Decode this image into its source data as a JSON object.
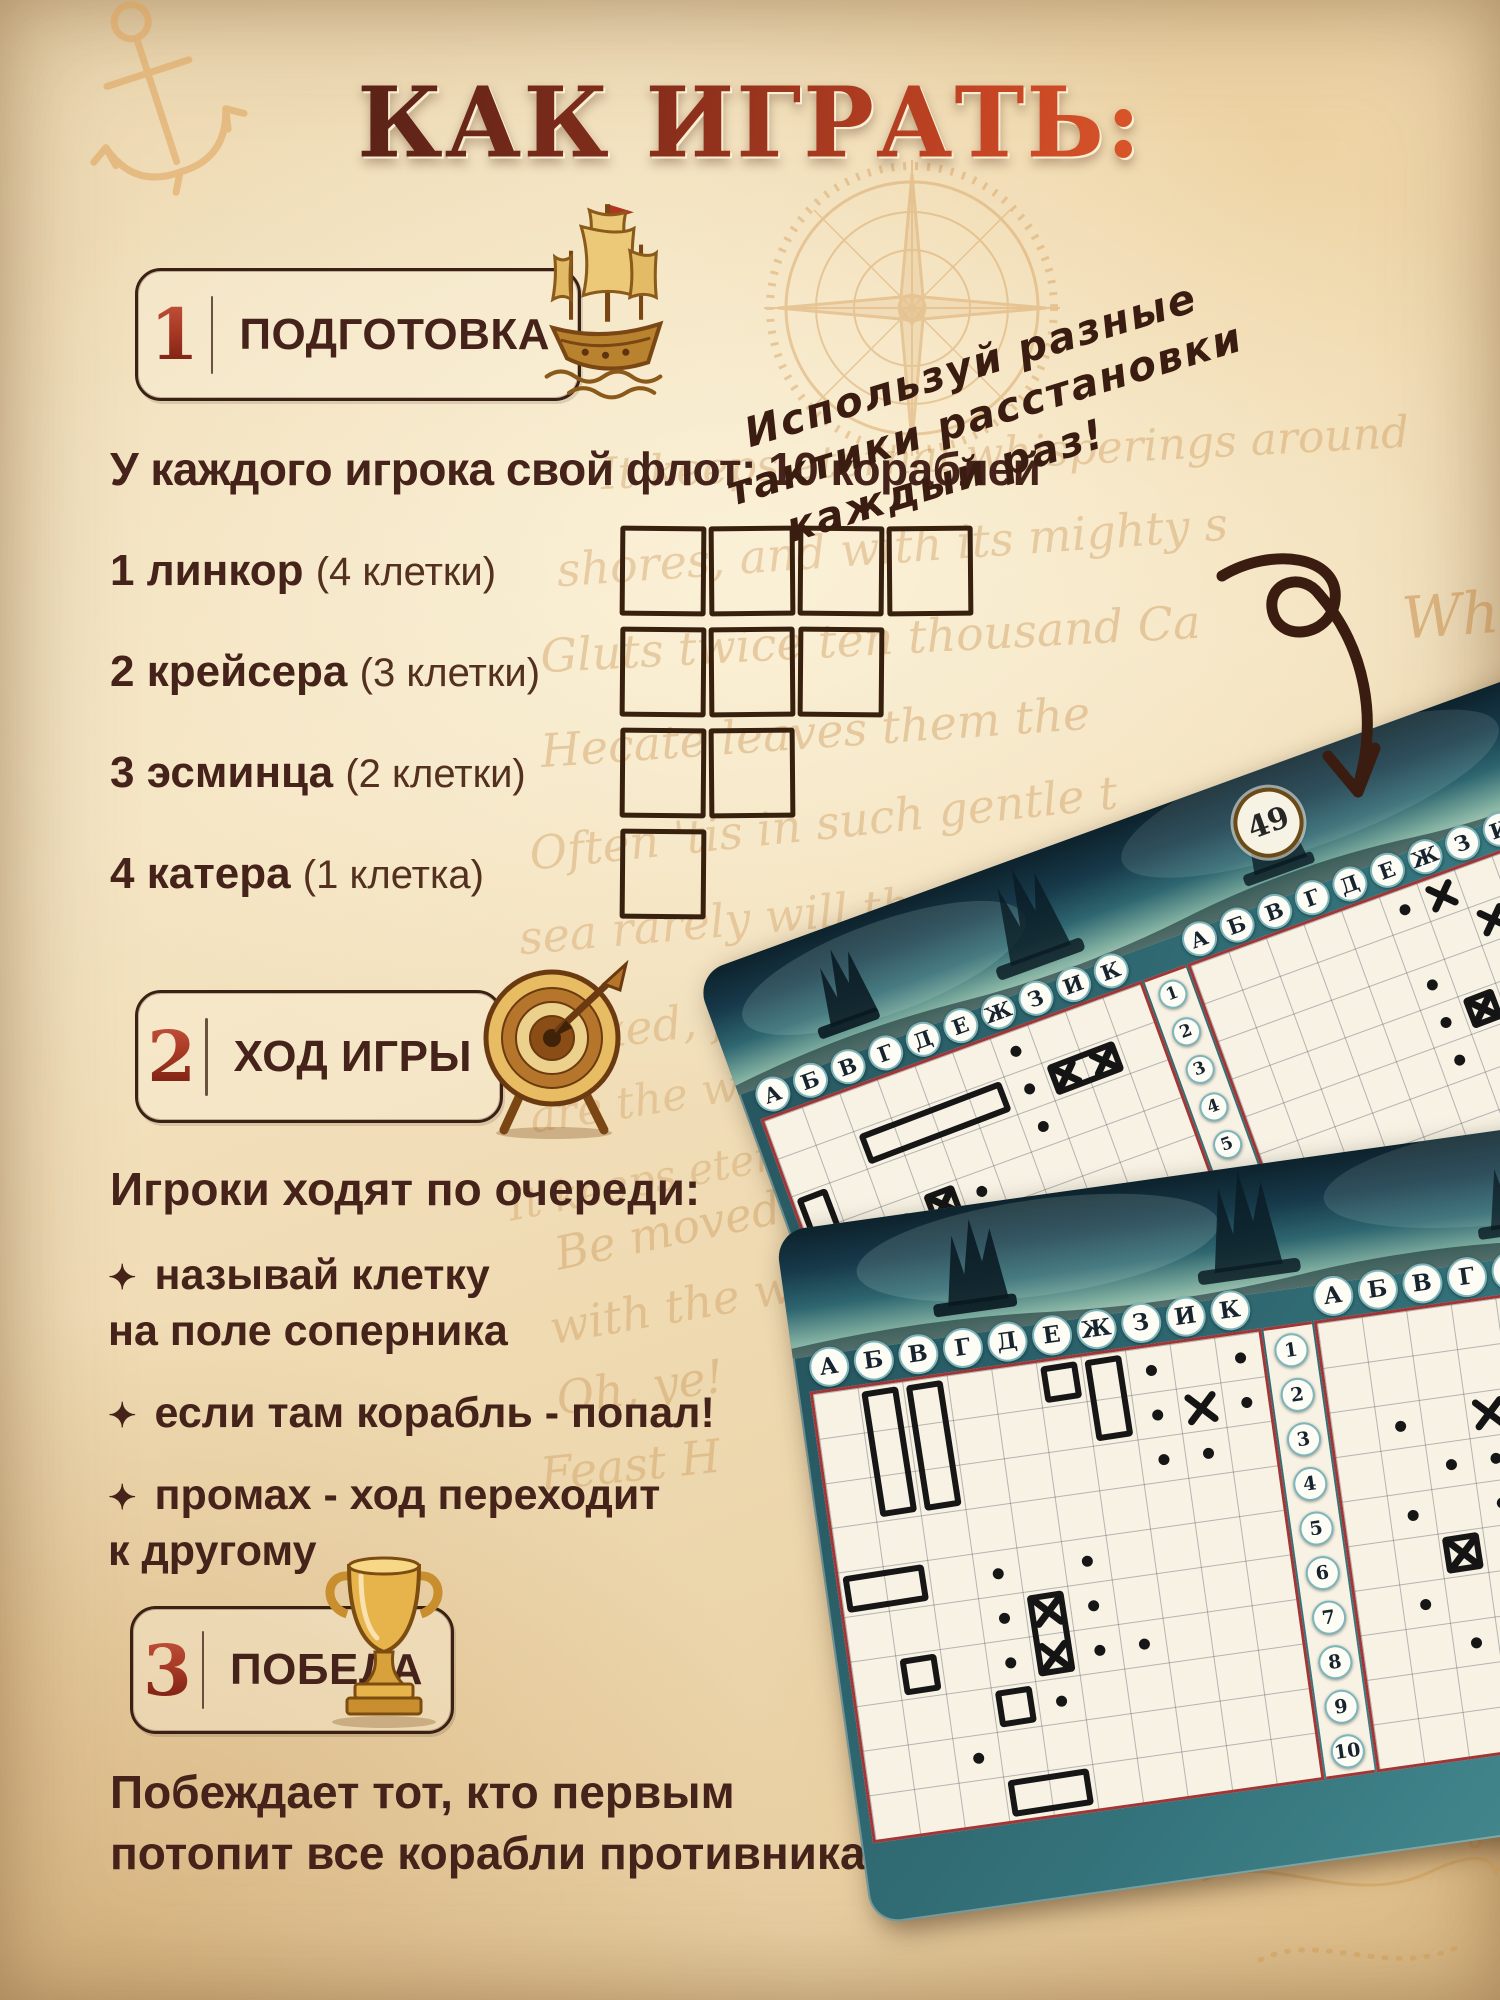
{
  "title": "КАК ИГРАТЬ:",
  "sections": [
    {
      "num": "1",
      "label": "ПОДГОТОВКА",
      "icon": "ship-icon"
    },
    {
      "num": "2",
      "label": "ХОД ИГРЫ",
      "icon": "target-icon"
    },
    {
      "num": "3",
      "label": "ПОБЕДА",
      "icon": "trophy-icon"
    }
  ],
  "fleet": {
    "heading": "У каждого игрока свой флот: 10 кораблей",
    "ships": [
      {
        "count": "1",
        "name": "линкор",
        "size": "(4 клетки)",
        "cells": 4
      },
      {
        "count": "2",
        "name": "крейсера",
        "size": "(3 клетки)",
        "cells": 3
      },
      {
        "count": "3",
        "name": "эсминца",
        "size": "(2 клетки)",
        "cells": 2
      },
      {
        "count": "4",
        "name": "катера",
        "size": "(1 клетка)",
        "cells": 1
      }
    ]
  },
  "note": {
    "lines": [
      "Используй разные",
      "тактики расстановки",
      "каждый раз!"
    ]
  },
  "turn": {
    "heading": "Игроки ходят по очереди:",
    "bullet_glyph": "✦",
    "bullets": [
      {
        "lines": [
          "называй клетку",
          "на поле соперника"
        ]
      },
      {
        "lines": [
          "если там корабль - попал!"
        ]
      },
      {
        "lines": [
          "промах - ход переходит",
          "к другому"
        ]
      }
    ]
  },
  "victory": {
    "lines": [
      "Побеждает тот,  кто первым",
      "потопит все корабли противника!"
    ]
  },
  "cards": {
    "column_letters": [
      "А",
      "Б",
      "В",
      "Г",
      "Д",
      "Е",
      "Ж",
      "З",
      "И",
      "К"
    ],
    "row_numbers": [
      "1",
      "2",
      "3",
      "4",
      "5",
      "6",
      "7",
      "8",
      "9",
      "10"
    ],
    "card1": {
      "badge": "49",
      "cell": 40,
      "left_grid": {
        "ships": [
          [
            0,
            2,
            1,
            2
          ],
          [
            2,
            1,
            4,
            1
          ],
          [
            5,
            4,
            1,
            1
          ],
          [
            3,
            6,
            1,
            1
          ],
          [
            0,
            7,
            2,
            1
          ]
        ],
        "sunk": [
          [
            7,
            1,
            2,
            1
          ],
          [
            3,
            3,
            1,
            1
          ],
          [
            1,
            5,
            1,
            1
          ]
        ],
        "hits": [],
        "dots": [
          [
            6,
            0
          ],
          [
            6,
            1
          ],
          [
            6,
            2
          ],
          [
            2,
            3
          ],
          [
            4,
            3
          ],
          [
            0,
            4
          ],
          [
            2,
            4
          ],
          [
            4,
            4
          ],
          [
            0,
            5
          ],
          [
            2,
            5
          ],
          [
            0,
            6
          ],
          [
            2,
            6
          ]
        ]
      },
      "right_grid": {
        "ships": [],
        "sunk": [
          [
            6,
            3,
            1,
            1
          ]
        ],
        "hits": [
          [
            6,
            0
          ],
          [
            7,
            1
          ]
        ],
        "dots": [
          [
            5,
            0
          ],
          [
            5,
            2
          ],
          [
            5,
            3
          ],
          [
            7,
            3
          ],
          [
            5,
            4
          ],
          [
            7,
            4
          ]
        ]
      }
    },
    "card2": {
      "cell": 45,
      "left_grid": {
        "ships": [
          [
            1,
            0,
            1,
            3
          ],
          [
            2,
            0,
            1,
            3
          ],
          [
            5,
            0,
            1,
            1
          ],
          [
            6,
            0,
            1,
            2
          ],
          [
            0,
            4,
            2,
            1
          ],
          [
            1,
            6,
            1,
            1
          ],
          [
            3,
            7,
            1,
            1
          ],
          [
            3,
            9,
            2,
            1
          ]
        ],
        "sunk": [
          [
            4,
            5,
            1,
            2
          ]
        ],
        "hits": [
          [
            8,
            1
          ]
        ],
        "dots": [
          [
            7,
            0
          ],
          [
            9,
            0
          ],
          [
            7,
            1
          ],
          [
            9,
            1
          ],
          [
            7,
            2
          ],
          [
            8,
            2
          ],
          [
            3,
            4
          ],
          [
            5,
            4
          ],
          [
            3,
            5
          ],
          [
            5,
            5
          ],
          [
            3,
            6
          ],
          [
            5,
            6
          ],
          [
            4,
            7
          ],
          [
            2,
            8
          ],
          [
            6,
            6
          ]
        ]
      },
      "right_grid": {
        "ships": [],
        "sunk": [
          [
            2,
            5,
            1,
            1
          ]
        ],
        "hits": [
          [
            3,
            2
          ]
        ],
        "dots": [
          [
            1,
            2
          ],
          [
            2,
            3
          ],
          [
            3,
            3
          ],
          [
            1,
            4
          ],
          [
            3,
            4
          ],
          [
            1,
            6
          ],
          [
            3,
            6
          ],
          [
            2,
            7
          ]
        ]
      }
    }
  },
  "background_script": [
    {
      "text": "It keeps eternal whisperings around",
      "x": 600,
      "y": 428,
      "size": 44,
      "rot": -3,
      "op": 0.3
    },
    {
      "text": "shores, and with its mighty s",
      "x": 556,
      "y": 520,
      "size": 46,
      "rot": -4,
      "op": 0.3
    },
    {
      "text": "Gluts twice ten thousand Ca",
      "x": 540,
      "y": 612,
      "size": 46,
      "rot": -3,
      "op": 0.32
    },
    {
      "text": "Hecate leaves them the",
      "x": 540,
      "y": 705,
      "size": 46,
      "rot": -4,
      "op": 0.32
    },
    {
      "text": "Often 'tis in such gentle t",
      "x": 528,
      "y": 796,
      "size": 46,
      "rot": -6,
      "op": 0.3
    },
    {
      "text": "sea rarely will the very",
      "x": 518,
      "y": 888,
      "size": 46,
      "rot": -5,
      "op": 0.28
    },
    {
      "text": "vexed, for days too",
      "x": 545,
      "y": 985,
      "size": 46,
      "rot": -7,
      "op": 0.28
    },
    {
      "text": "are the winds b",
      "x": 528,
      "y": 1066,
      "size": 44,
      "rot": -9,
      "op": 0.26
    },
    {
      "text": "It keeps eternal",
      "x": 505,
      "y": 1150,
      "size": 42,
      "rot": -11,
      "op": 0.26
    },
    {
      "text": "Whe",
      "x": 1402,
      "y": 580,
      "size": 58,
      "rot": -4,
      "op": 0.45
    },
    {
      "text": "Be moved for",
      "x": 552,
      "y": 1195,
      "size": 46,
      "rot": -12,
      "op": 0.3
    },
    {
      "text": "with the w",
      "x": 548,
      "y": 1280,
      "size": 46,
      "rot": -10,
      "op": 0.28
    },
    {
      "text": "Oh, ye!",
      "x": 556,
      "y": 1360,
      "size": 46,
      "rot": -8,
      "op": 0.3
    },
    {
      "text": "Feast H",
      "x": 540,
      "y": 1438,
      "size": 46,
      "rot": -6,
      "op": 0.28
    }
  ],
  "icons": {
    "ship-icon": "golden sailing galleon",
    "target-icon": "archery target with arrow",
    "trophy-icon": "golden trophy cup",
    "anchor-icon": "sketched anchor",
    "compass-icon": "compass rose",
    "arrow-icon": "hand-drawn curled arrow",
    "diamond-bullet-icon": "four-point star bullet"
  },
  "colors": {
    "text_brown": "#45231a",
    "accent_red": "#a83a26",
    "parchment": "#f0ddb8",
    "card_teal": "#35747c",
    "grid_red": "#a23636",
    "gold": "#c8913f",
    "ink_black": "#161616",
    "script_orange": "#c08038"
  }
}
